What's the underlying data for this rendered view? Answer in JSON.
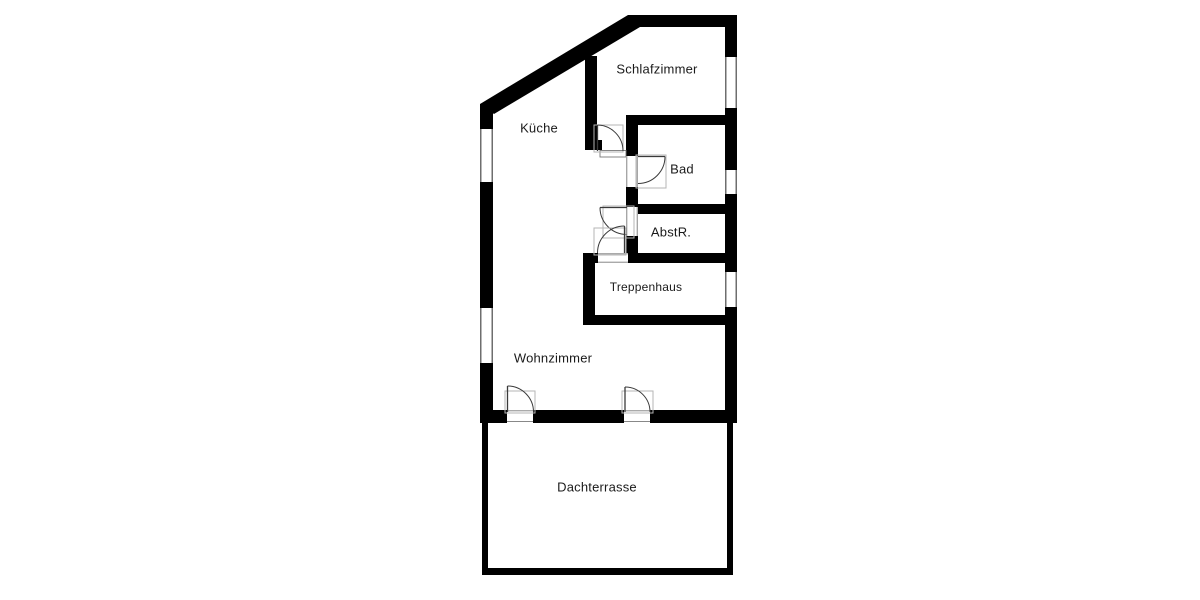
{
  "plan": {
    "type": "floor-plan",
    "rooms": [
      {
        "id": "schlafzimmer",
        "label": "Schlafzimmer"
      },
      {
        "id": "kueche",
        "label": "Küche"
      },
      {
        "id": "bad",
        "label": "Bad"
      },
      {
        "id": "abstellraum",
        "label": "AbstR."
      },
      {
        "id": "treppenhaus",
        "label": "Treppenhaus"
      },
      {
        "id": "wohnzimmer",
        "label": "Wohnzimmer"
      },
      {
        "id": "dachterrasse",
        "label": "Dachterrasse"
      }
    ],
    "colors": {
      "wall": "#000000",
      "background": "#ffffff",
      "label_text": "#1a1a1a",
      "door_line": "#3a3a3a",
      "door_frame": "#b5b5b5",
      "window_line": "#4a4a4a",
      "opening_line": "#777777"
    }
  }
}
